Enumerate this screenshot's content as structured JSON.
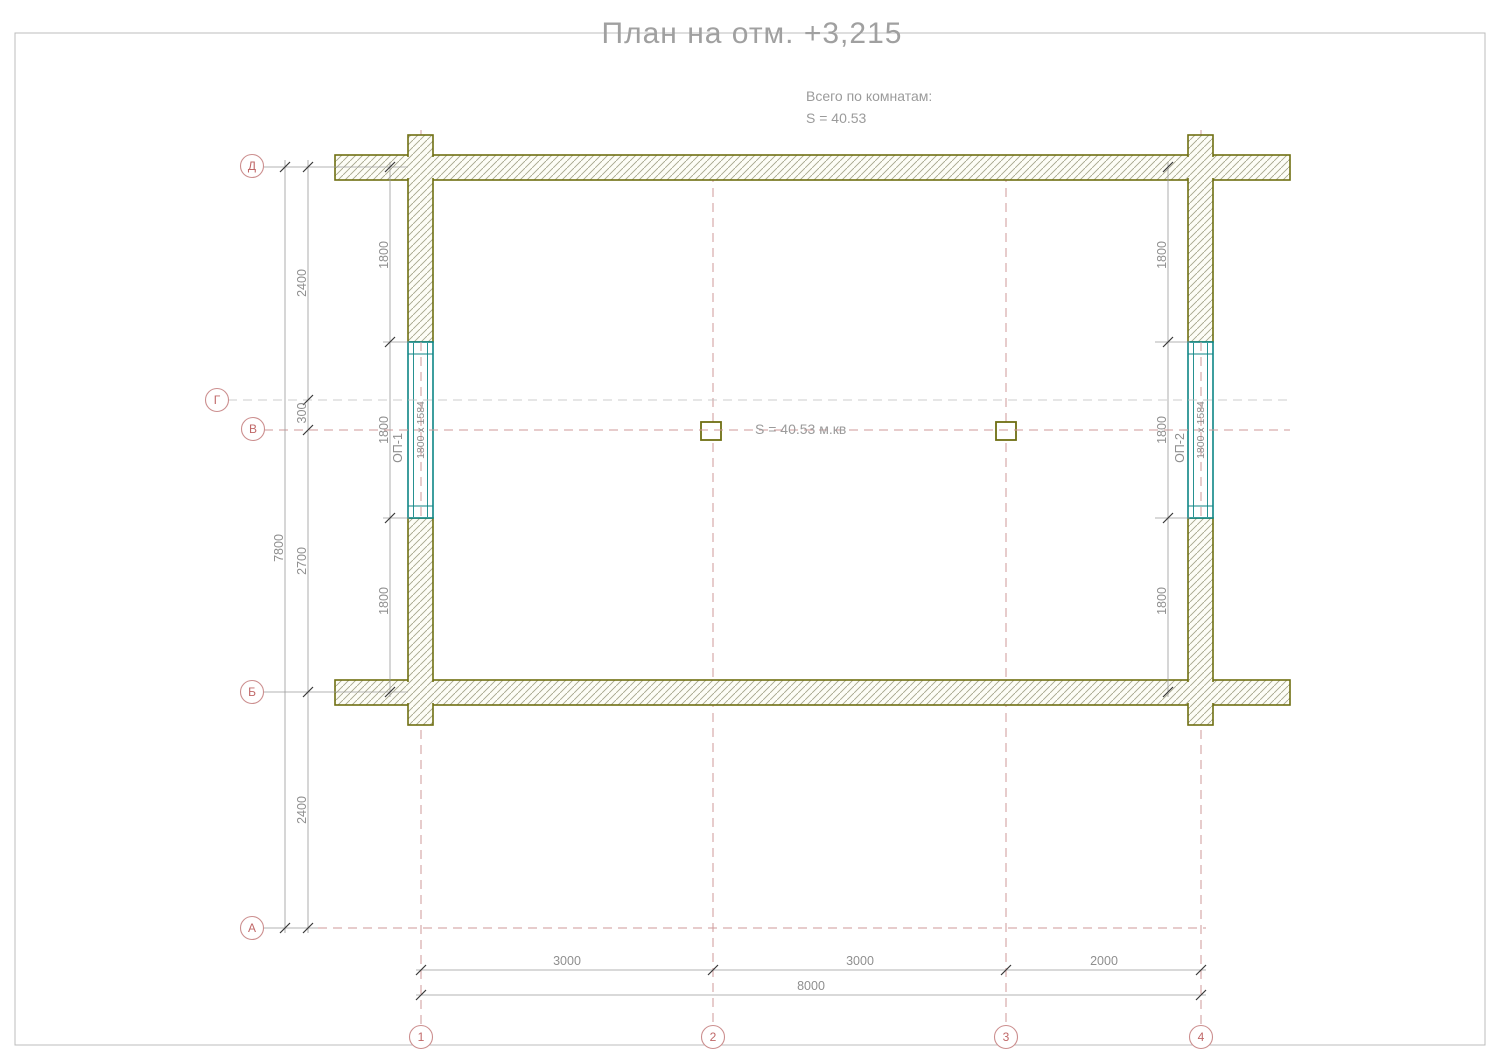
{
  "title": "План на отм. +3,215",
  "notes": {
    "rooms_total": "Всего по комнатам:",
    "rooms_area": "S    =    40.53"
  },
  "area_label": "S   =   40.53 м.кв",
  "axes": {
    "rows": [
      {
        "label": "Д"
      },
      {
        "label": "Г"
      },
      {
        "label": "В"
      },
      {
        "label": "Б"
      },
      {
        "label": "А"
      }
    ],
    "cols": [
      {
        "label": "1"
      },
      {
        "label": "2"
      },
      {
        "label": "3"
      },
      {
        "label": "4"
      }
    ]
  },
  "dims": {
    "left_total": "7800",
    "left_top": "2400",
    "left_mid": "300",
    "left_lower": "2700",
    "left_bottom": "2400",
    "win_left_top": "1800",
    "win_left_mid": "1800",
    "win_left_bot": "1800",
    "win_right_top": "1800",
    "win_right_mid": "1800",
    "win_right_bot": "1800",
    "bottom_1": "3000",
    "bottom_2": "3000",
    "bottom_3": "2000",
    "bottom_total": "8000"
  },
  "windows": {
    "w1_label": "ОП-1",
    "w1_size": "1800 х 1584",
    "w2_label": "ОП-2",
    "w2_size": "1800 х 1584"
  },
  "colors": {
    "wall_outline": "#6f6f12",
    "hatch_line": "#a6a68c",
    "axis_red": "#c06868",
    "dim_gray": "#8f8f8f",
    "window_teal": "#0e8585"
  }
}
